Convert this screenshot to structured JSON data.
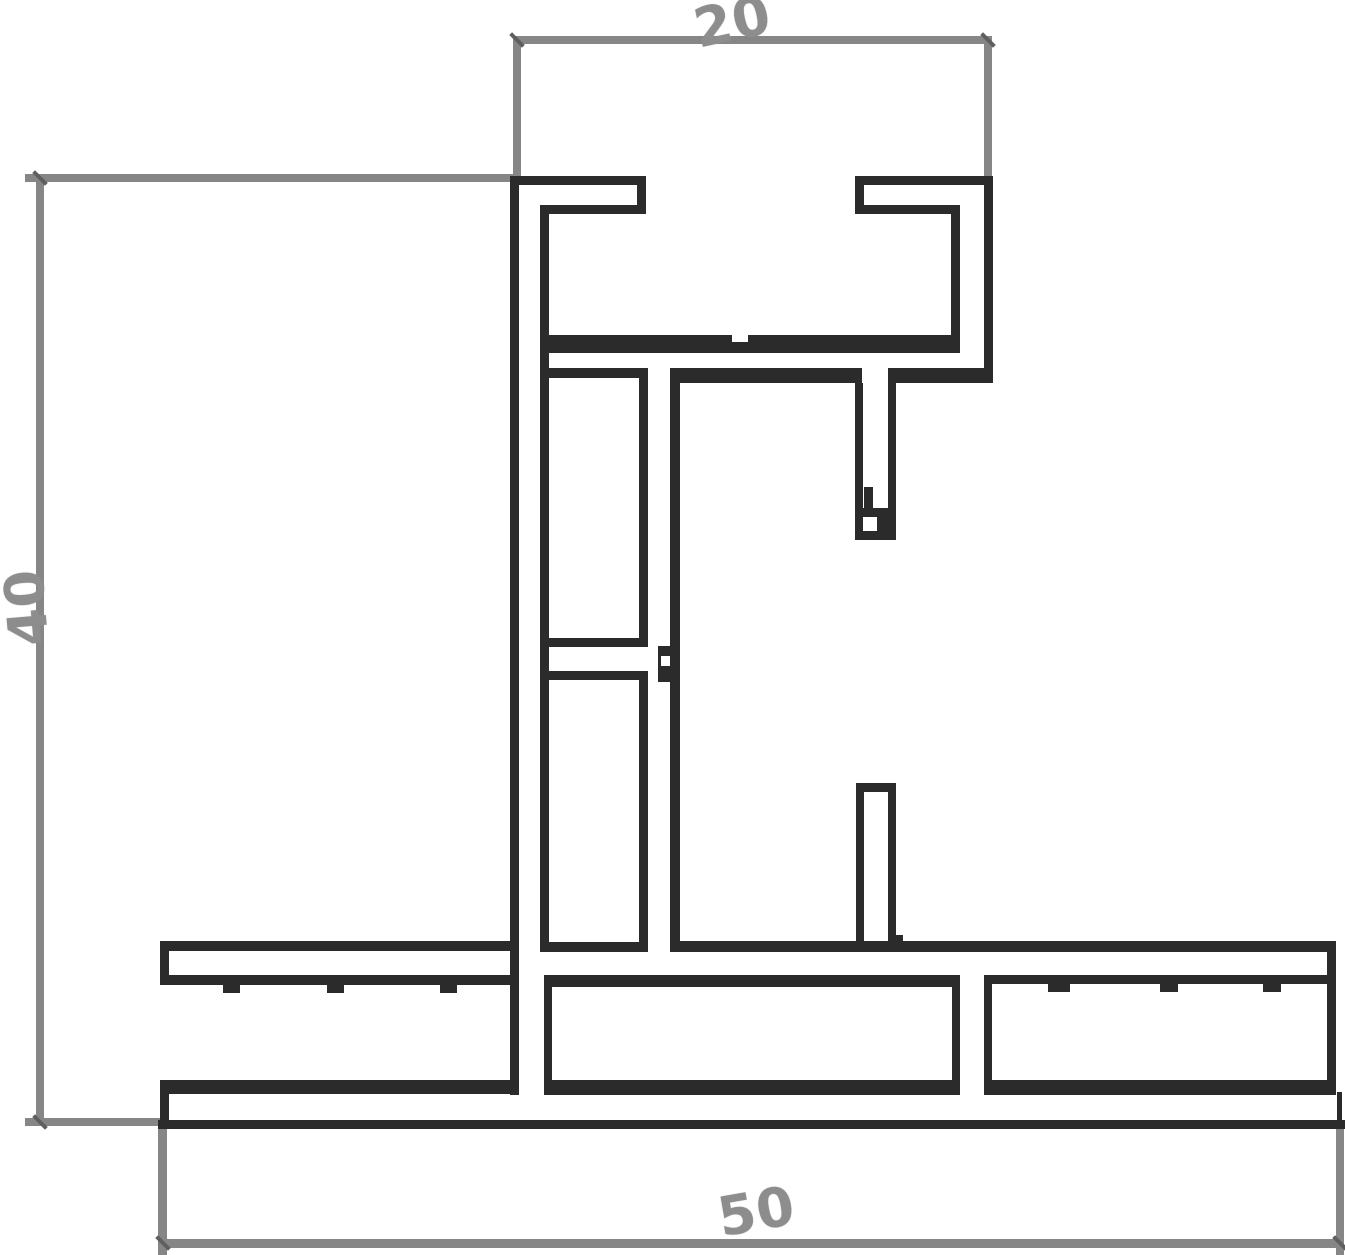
{
  "labels": {
    "top": "20",
    "left": "40",
    "bottom": "50"
  },
  "colors": {
    "background": "#ffffff",
    "profile": "#2b2b2b",
    "dimension": "#868686",
    "label_text": "#8d8d8d",
    "tick": "#5f5f5f"
  },
  "drawing": {
    "profile_rects": [
      {
        "x": 510,
        "y": 176,
        "w": 9,
        "h": 919
      },
      {
        "x": 510,
        "y": 176,
        "w": 136,
        "h": 9
      },
      {
        "x": 637,
        "y": 176,
        "w": 9,
        "h": 38
      },
      {
        "x": 540,
        "y": 205,
        "w": 106,
        "h": 9
      },
      {
        "x": 540,
        "y": 205,
        "w": 9,
        "h": 747
      },
      {
        "x": 855,
        "y": 176,
        "w": 138,
        "h": 9
      },
      {
        "x": 855,
        "y": 176,
        "w": 9,
        "h": 38
      },
      {
        "x": 855,
        "y": 205,
        "w": 105,
        "h": 9
      },
      {
        "x": 951,
        "y": 205,
        "w": 9,
        "h": 148
      },
      {
        "x": 540,
        "y": 335,
        "w": 420,
        "h": 18
      },
      {
        "x": 984,
        "y": 176,
        "w": 9,
        "h": 207
      },
      {
        "x": 670,
        "y": 368,
        "w": 192,
        "h": 15
      },
      {
        "x": 888,
        "y": 368,
        "w": 105,
        "h": 15
      },
      {
        "x": 540,
        "y": 368,
        "w": 108,
        "h": 10
      },
      {
        "x": 639,
        "y": 368,
        "w": 9,
        "h": 279
      },
      {
        "x": 540,
        "y": 638,
        "w": 108,
        "h": 9
      },
      {
        "x": 540,
        "y": 671,
        "w": 108,
        "h": 9
      },
      {
        "x": 639,
        "y": 671,
        "w": 9,
        "h": 281
      },
      {
        "x": 540,
        "y": 942,
        "w": 108,
        "h": 10
      },
      {
        "x": 670,
        "y": 368,
        "w": 10,
        "h": 584
      },
      {
        "x": 658,
        "y": 646,
        "w": 12,
        "h": 36
      },
      {
        "x": 855,
        "y": 383,
        "w": 8,
        "h": 157
      },
      {
        "x": 888,
        "y": 383,
        "w": 8,
        "h": 157
      },
      {
        "x": 855,
        "y": 531,
        "w": 41,
        "h": 9
      },
      {
        "x": 863,
        "y": 508,
        "w": 25,
        "h": 9
      },
      {
        "x": 864,
        "y": 487,
        "w": 9,
        "h": 21
      },
      {
        "x": 877,
        "y": 517,
        "w": 19,
        "h": 14
      },
      {
        "x": 856,
        "y": 783,
        "w": 40,
        "h": 9
      },
      {
        "x": 856,
        "y": 783,
        "w": 8,
        "h": 169
      },
      {
        "x": 888,
        "y": 783,
        "w": 8,
        "h": 169
      },
      {
        "x": 893,
        "y": 935,
        "w": 10,
        "h": 9
      },
      {
        "x": 160,
        "y": 941,
        "w": 350,
        "h": 10
      },
      {
        "x": 670,
        "y": 941,
        "w": 666,
        "h": 11
      },
      {
        "x": 160,
        "y": 941,
        "w": 9,
        "h": 44
      },
      {
        "x": 160,
        "y": 975,
        "w": 358,
        "h": 10
      },
      {
        "x": 984,
        "y": 975,
        "w": 352,
        "h": 9
      },
      {
        "x": 1327,
        "y": 941,
        "w": 9,
        "h": 154
      },
      {
        "x": 223,
        "y": 985,
        "w": 17,
        "h": 8
      },
      {
        "x": 327,
        "y": 985,
        "w": 17,
        "h": 8
      },
      {
        "x": 440,
        "y": 985,
        "w": 17,
        "h": 8
      },
      {
        "x": 1048,
        "y": 983,
        "w": 22,
        "h": 9
      },
      {
        "x": 1160,
        "y": 983,
        "w": 18,
        "h": 9
      },
      {
        "x": 1263,
        "y": 983,
        "w": 18,
        "h": 9
      },
      {
        "x": 544,
        "y": 975,
        "w": 416,
        "h": 12
      },
      {
        "x": 544,
        "y": 975,
        "w": 8,
        "h": 120
      },
      {
        "x": 952,
        "y": 975,
        "w": 8,
        "h": 120
      },
      {
        "x": 544,
        "y": 1080,
        "w": 416,
        "h": 15
      },
      {
        "x": 160,
        "y": 1080,
        "w": 358,
        "h": 14
      },
      {
        "x": 160,
        "y": 1080,
        "w": 9,
        "h": 43
      },
      {
        "x": 984,
        "y": 1080,
        "w": 352,
        "h": 15
      },
      {
        "x": 984,
        "y": 975,
        "w": 8,
        "h": 120
      },
      {
        "x": 1337,
        "y": 1092,
        "w": 5,
        "h": 31
      },
      {
        "x": 158,
        "y": 1120,
        "w": 1187,
        "h": 9
      }
    ],
    "white_rects": [
      {
        "x": 732,
        "y": 335,
        "w": 16,
        "h": 7
      },
      {
        "x": 661,
        "y": 656,
        "w": 9,
        "h": 10
      }
    ],
    "dimension_rects": [
      {
        "x": 513,
        "y": 36,
        "w": 479,
        "h": 8
      },
      {
        "x": 513,
        "y": 36,
        "w": 8,
        "h": 140
      },
      {
        "x": 984,
        "y": 36,
        "w": 8,
        "h": 140
      },
      {
        "x": 36,
        "y": 174,
        "w": 8,
        "h": 952
      },
      {
        "x": 25,
        "y": 174,
        "w": 492,
        "h": 8
      },
      {
        "x": 25,
        "y": 1118,
        "w": 143,
        "h": 8
      },
      {
        "x": 158,
        "y": 1239,
        "w": 1186,
        "h": 9
      },
      {
        "x": 158,
        "y": 1120,
        "w": 9,
        "h": 135
      },
      {
        "x": 1336,
        "y": 1128,
        "w": 8,
        "h": 127
      }
    ],
    "ticks": [
      {
        "cx": 517,
        "cy": 40
      },
      {
        "cx": 988,
        "cy": 40
      },
      {
        "cx": 40,
        "cy": 178
      },
      {
        "cx": 40,
        "cy": 1122
      },
      {
        "cx": 163,
        "cy": 1243
      },
      {
        "cx": 1340,
        "cy": 1243
      }
    ]
  }
}
